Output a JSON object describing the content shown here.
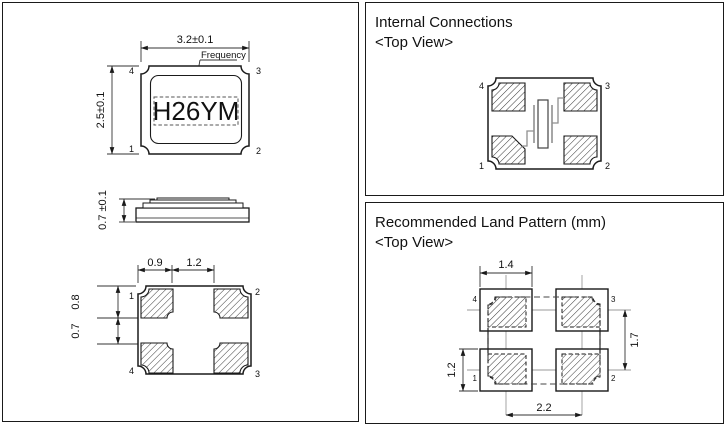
{
  "outline_panel": {
    "top_view": {
      "width_dim": "3.2±0.1",
      "height_dim": "2.5±0.1",
      "frequency_label": "Frequency",
      "marking": "H26YM",
      "pin_tl": "4",
      "pin_tr": "3",
      "pin_bl": "1",
      "pin_br": "2"
    },
    "side_view": {
      "height_dim": "0.7 ±0.1"
    },
    "bottom_view": {
      "dim_a": "0.9",
      "dim_b": "1.2",
      "dim_c": "0.8",
      "dim_d": "0.7",
      "pin_tl": "1",
      "pin_tr": "2",
      "pin_bl": "4",
      "pin_br": "3"
    }
  },
  "internal_panel": {
    "title": "Internal Connections",
    "subtitle": "<Top View>",
    "pin_tl": "4",
    "pin_tr": "3",
    "pin_bl": "1",
    "pin_br": "2"
  },
  "land_panel": {
    "title": "Recommended Land Pattern (mm)",
    "subtitle": "<Top View>",
    "dim_pad_width": "1.4",
    "dim_v_pitch": "1.7",
    "dim_pad_height": "1.2",
    "dim_h_pitch": "2.2",
    "pin_tl": "4",
    "pin_tr": "3",
    "pin_bl": "1",
    "pin_br": "2"
  },
  "colors": {
    "line": "#1a1a1a",
    "gray": "#8f8f8f"
  }
}
